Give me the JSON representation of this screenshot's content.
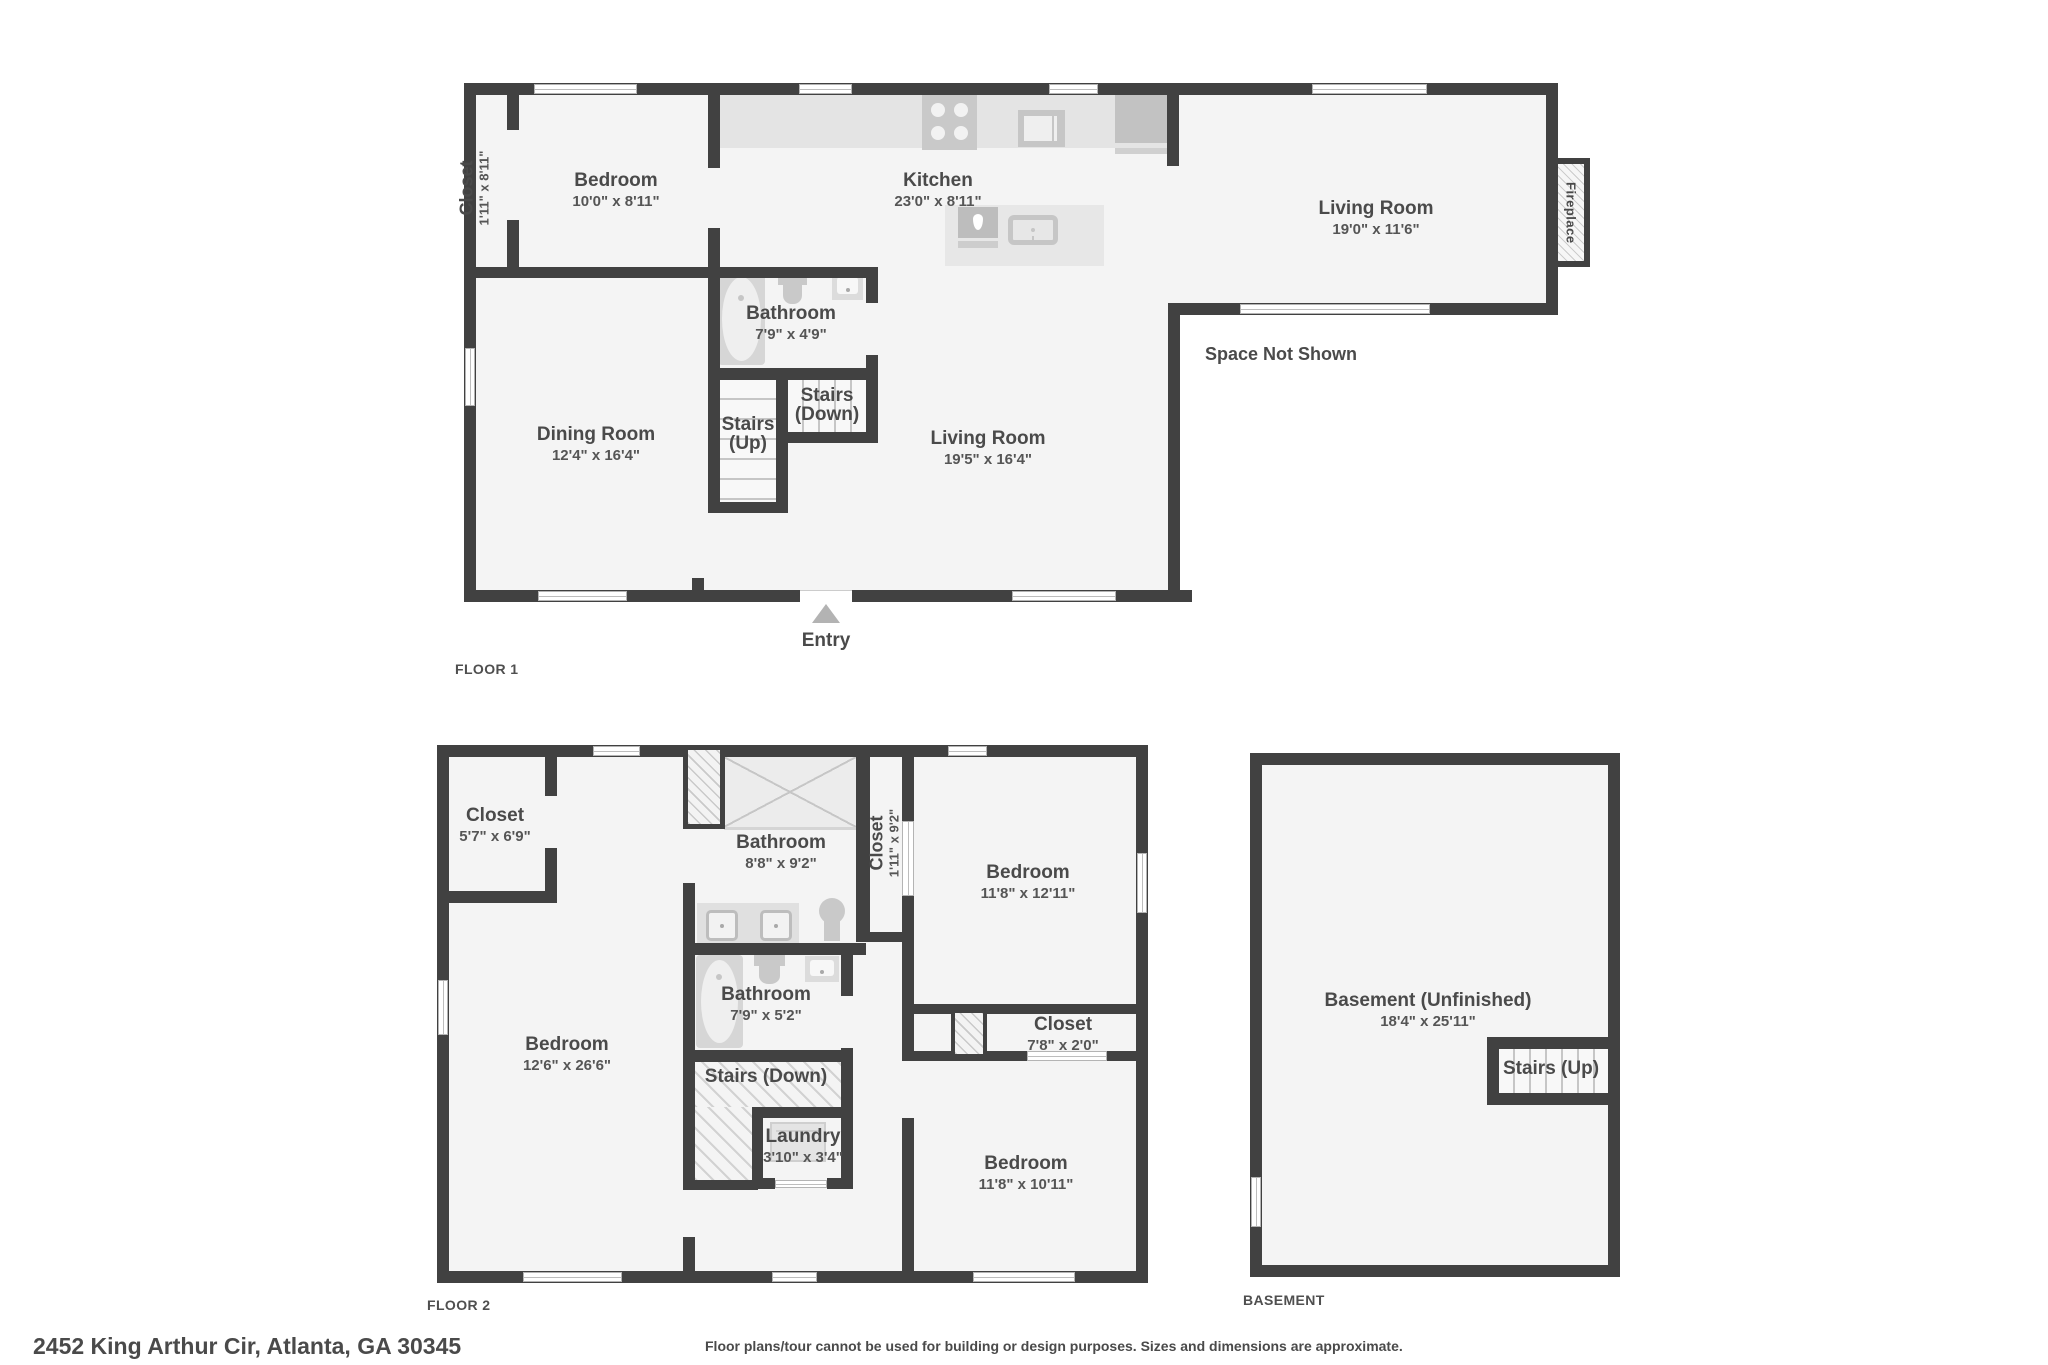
{
  "page": {
    "address": "2452 King Arthur Cir, Atlanta, GA 30345",
    "disclaimer": "Floor plans/tour cannot be used for building or design purposes. Sizes and dimensions are approximate."
  },
  "colors": {
    "wall": "#414141",
    "floor_fill": "#f4f4f4",
    "counter": "#e4e4e4",
    "fixture": "#c9c9c9",
    "text": "#4a4a4a"
  },
  "icons": {
    "entry-triangle-icon": "css-triangle",
    "stove-icon": "css-shape-burners",
    "microwave-icon": "css-rect",
    "refrigerator-icon": "css-rect",
    "island-sink-icon": "css-teardrop",
    "dishwasher-icon": "css-rounded-rect",
    "bathtub-icon": "css-oval",
    "toilet-icon": "css-oval-rect",
    "sink-icon": "css-square-dot",
    "shower-icon": "css-x-box",
    "washer-icon": "css-square",
    "fireplace-icon": "hatched-box",
    "chimney-icon": "hatched-box"
  },
  "floor1": {
    "label": "FLOOR 1",
    "entry_label": "Entry",
    "space_not_shown": "Space Not Shown",
    "fireplace": "Fireplace",
    "rooms": {
      "closet": {
        "name": "Closet",
        "dims": "1'11\" x 8'11\""
      },
      "bedroom": {
        "name": "Bedroom",
        "dims": "10'0\" x 8'11\""
      },
      "kitchen": {
        "name": "Kitchen",
        "dims": "23'0\" x 8'11\""
      },
      "living_upper": {
        "name": "Living Room",
        "dims": "19'0\" x 11'6\""
      },
      "dining": {
        "name": "Dining Room",
        "dims": "12'4\" x 16'4\""
      },
      "bathroom": {
        "name": "Bathroom",
        "dims": "7'9\" x 4'9\""
      },
      "stairs_up": {
        "name": "Stairs",
        "sub": "(Up)"
      },
      "stairs_down": {
        "name": "Stairs",
        "sub": "(Down)"
      },
      "living_main": {
        "name": "Living Room",
        "dims": "19'5\" x 16'4\""
      }
    }
  },
  "floor2": {
    "label": "FLOOR 2",
    "rooms": {
      "closet_tl": {
        "name": "Closet",
        "dims": "5'7\" x 6'9\""
      },
      "bathroom_upper": {
        "name": "Bathroom",
        "dims": "8'8\" x 9'2\""
      },
      "closet_vert": {
        "name": "Closet",
        "dims": "1'11\" x 9'2\""
      },
      "bedroom_tr": {
        "name": "Bedroom",
        "dims": "11'8\" x 12'11\""
      },
      "bathroom_lower": {
        "name": "Bathroom",
        "dims": "7'9\" x 5'2\""
      },
      "bedroom_left": {
        "name": "Bedroom",
        "dims": "12'6\" x 26'6\""
      },
      "stairs_down": {
        "name": "Stairs (Down)"
      },
      "laundry": {
        "name": "Laundry",
        "dims": "3'10\" x 3'4\""
      },
      "closet_strip": {
        "name": "Closet",
        "dims": "7'8\" x 2'0\""
      },
      "bedroom_br": {
        "name": "Bedroom",
        "dims": "11'8\" x 10'11\""
      }
    }
  },
  "basement": {
    "label": "BASEMENT",
    "room": {
      "name": "Basement (Unfinished)",
      "dims": "18'4\" x 25'11\""
    },
    "stairs_up": {
      "name": "Stairs (Up)"
    }
  }
}
